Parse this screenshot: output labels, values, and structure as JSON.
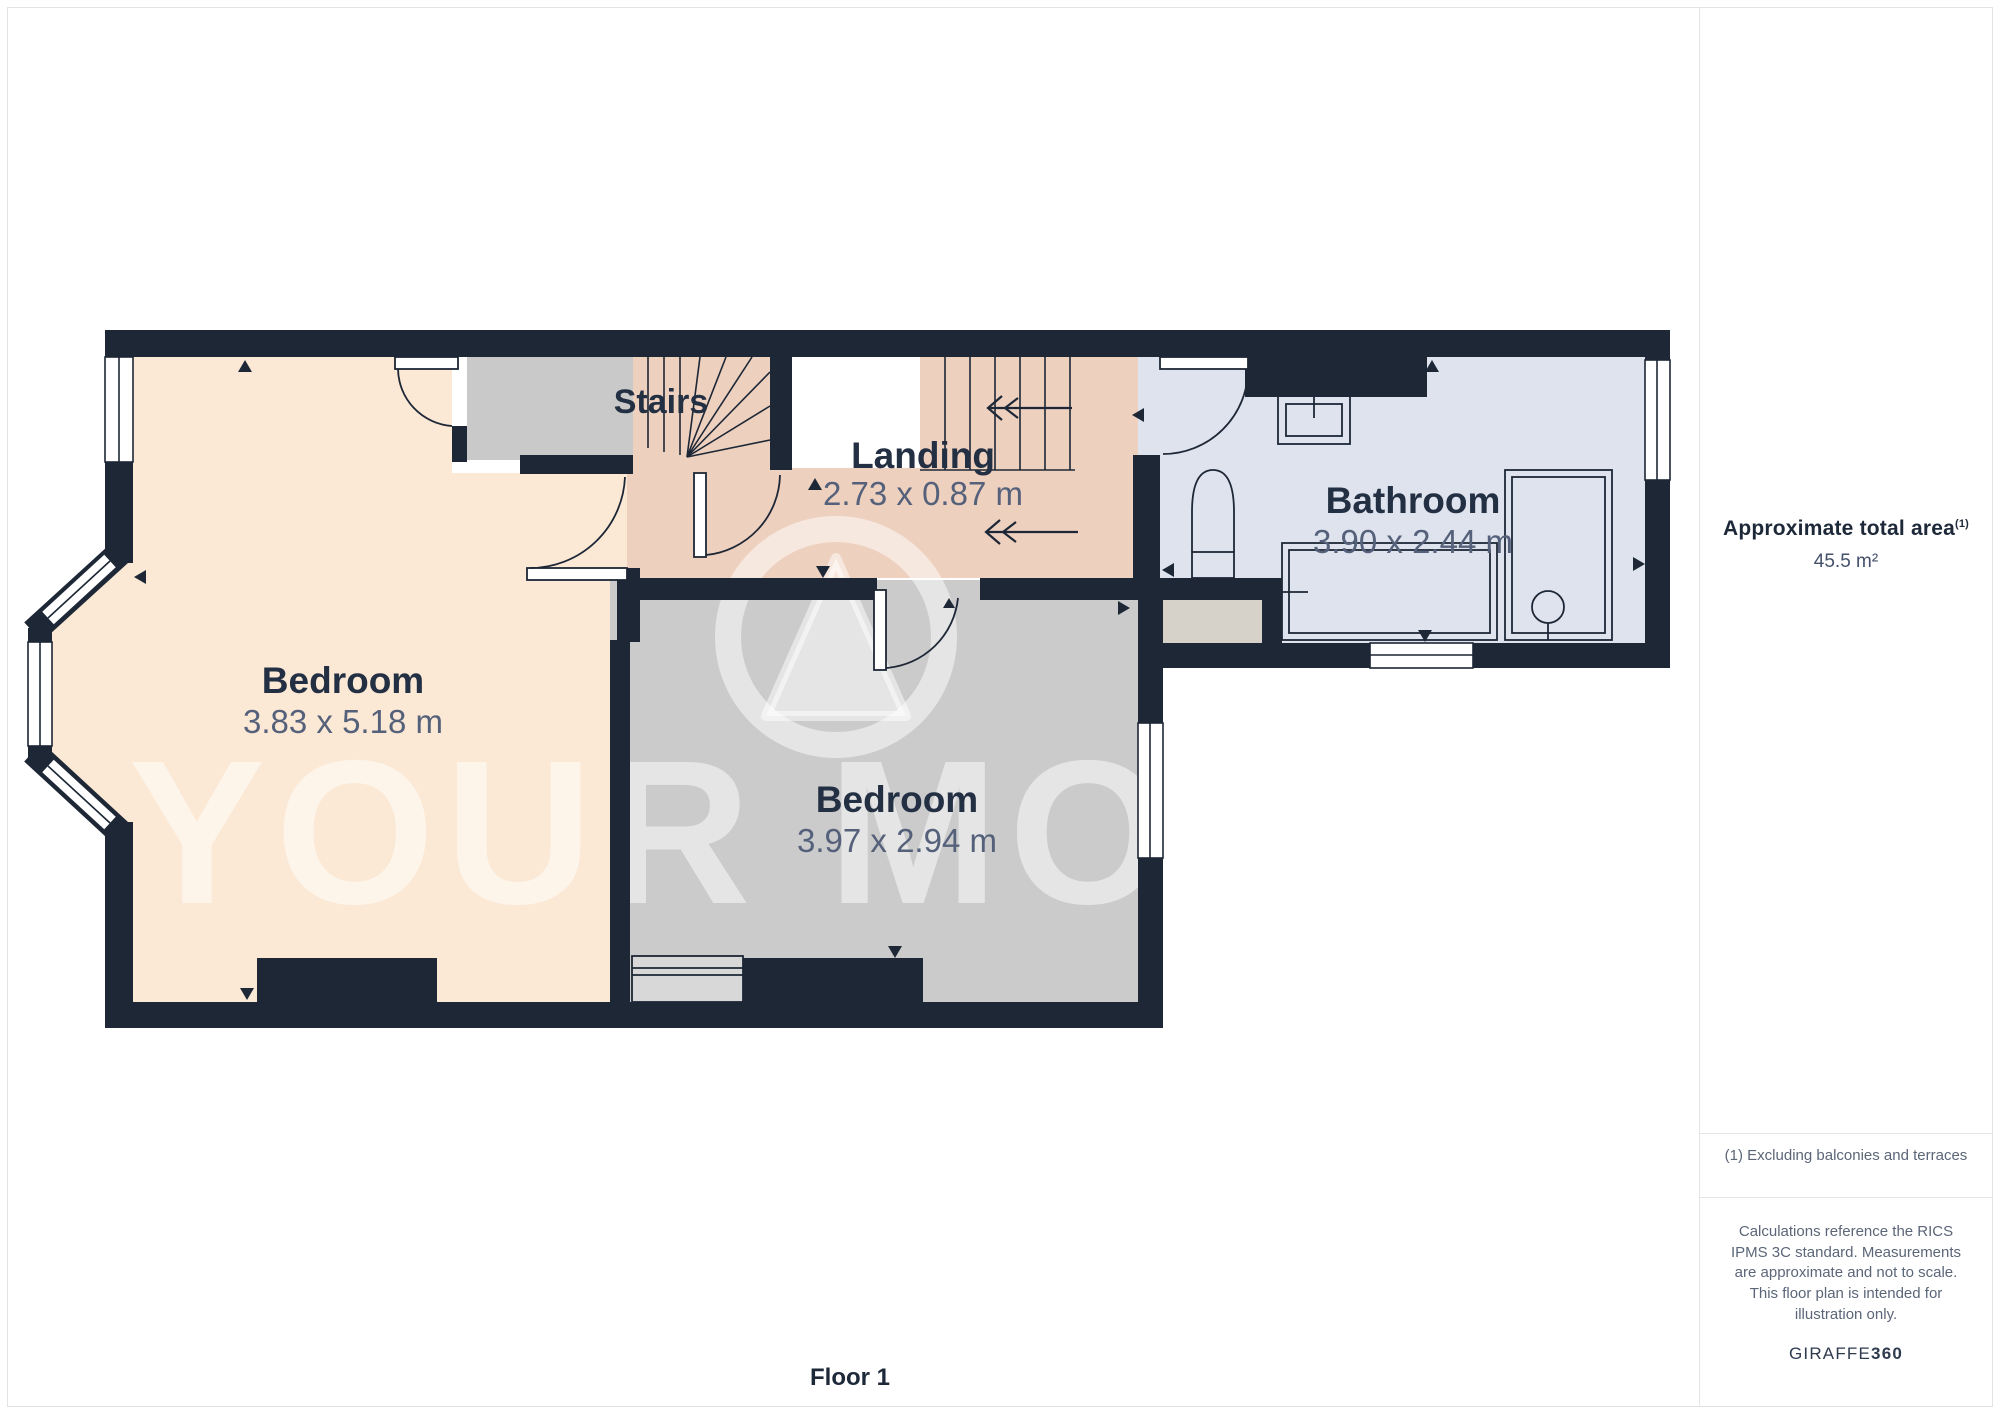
{
  "page": {
    "floor_label": "Floor 1",
    "watermark": "YOUR MOVE"
  },
  "sidebar": {
    "area_title": "Approximate total area",
    "area_title_sup": "(1)",
    "area_value": "45.5 m²",
    "footnote": "(1) Excluding balconies and terraces",
    "disclaimer": "Calculations reference the RICS IPMS 3C standard. Measurements are approximate and not to scale. This floor plan is intended for illustration only.",
    "brand_name": "GIRAFFE",
    "brand_suffix": "360"
  },
  "rooms": {
    "bedroom1": {
      "name": "Bedroom",
      "dims": "3.83 x 5.18 m"
    },
    "bedroom2": {
      "name": "Bedroom",
      "dims": "3.97 x 2.94 m"
    },
    "bathroom": {
      "name": "Bathroom",
      "dims": "3.90 x 2.44 m"
    },
    "landing": {
      "name": "Landing",
      "dims": "2.73 x 0.87 m"
    },
    "stairs": {
      "name": "Stairs"
    }
  },
  "colors": {
    "wall": "#1d2736",
    "bedroom1_floor": "#fbe9d6",
    "bedroom2_floor": "#cbcbcb",
    "bathroom_floor": "#dee3ee",
    "landing_floor": "#eed0bf",
    "platform_floor": "#c9c9c9",
    "alcove_floor": "#d6d2c9",
    "label_text": "#232f42",
    "dims_text": "#55617a"
  }
}
